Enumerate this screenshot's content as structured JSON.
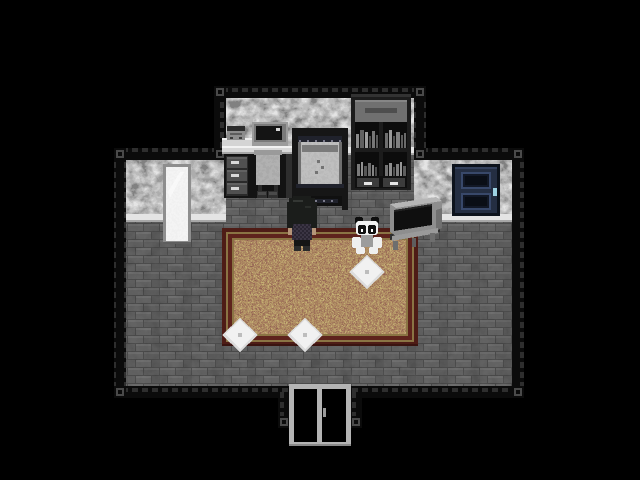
{
  "scene": {
    "label": "Top-down pixel-art bedroom: grayscale stone room with red patterned rug, player character standing at center",
    "background": "#000000"
  },
  "room": {
    "border_color": "#0b0b0b",
    "border_dash_color": "#2e2e2e",
    "wall_shades": [
      "#383838",
      "#545454",
      "#6b6b6b",
      "#848484",
      "#9e9e9e"
    ],
    "floor_brick": "#565656",
    "floor_mortar": "#3e3e3e",
    "baseboard_color": "#e4e4e4"
  },
  "objects": {
    "mirror": {
      "label": "tall standing mirror on left wall",
      "frame": "#8e8e8e",
      "glass": "#e9e9e9"
    },
    "desk": {
      "label": "desk with CRT monitor, game console, three drawers, chair and slippers",
      "top": "#d8d8d8",
      "monitor_screen": "#141414",
      "console_body": "#8c8c8c"
    },
    "bed": {
      "label": "single bed with dark frame and gray mattress",
      "frame": "#161616",
      "mattress": "#8c8c8c"
    },
    "bookshelf": {
      "label": "dark bookshelf with gray books and two drawers with white handles",
      "frame": "#1c1c1c",
      "drawer": "#3c3c3c",
      "handles": "#e6e6e6"
    },
    "blue_door": {
      "label": "dark blue paneled door on right wall",
      "face": "#242e42",
      "panel_trim": "#38486a",
      "handle": "#9ed3e4"
    },
    "tv": {
      "label": "gray CRT television on small stand facing left",
      "body": "#8e8e8e",
      "screen": "#0f0f0f"
    },
    "plush_panda": {
      "label": "small panda plush sitting on the rug",
      "head": "#f2f2f2",
      "body": "#9c9c9c",
      "ears": "#0e0e0e"
    },
    "character": {
      "label": "player character with black bob haircut seen from behind, checkered top",
      "hair": "#1b1d1b",
      "skin": "#b59579",
      "shirt": "#3b3544"
    },
    "rug": {
      "label": "large red-brown mottled rug with gold trim border",
      "border": "#4e1c16",
      "trim": "#8a7444",
      "field": "#5c2a1c"
    },
    "cushions": {
      "label": "white diamond floor cushions",
      "count": 3,
      "color": "#ececec"
    },
    "entry_doorway": {
      "label": "double entry door at bottom of room",
      "frame": "#b4b4b4",
      "panels": "#000000"
    }
  }
}
